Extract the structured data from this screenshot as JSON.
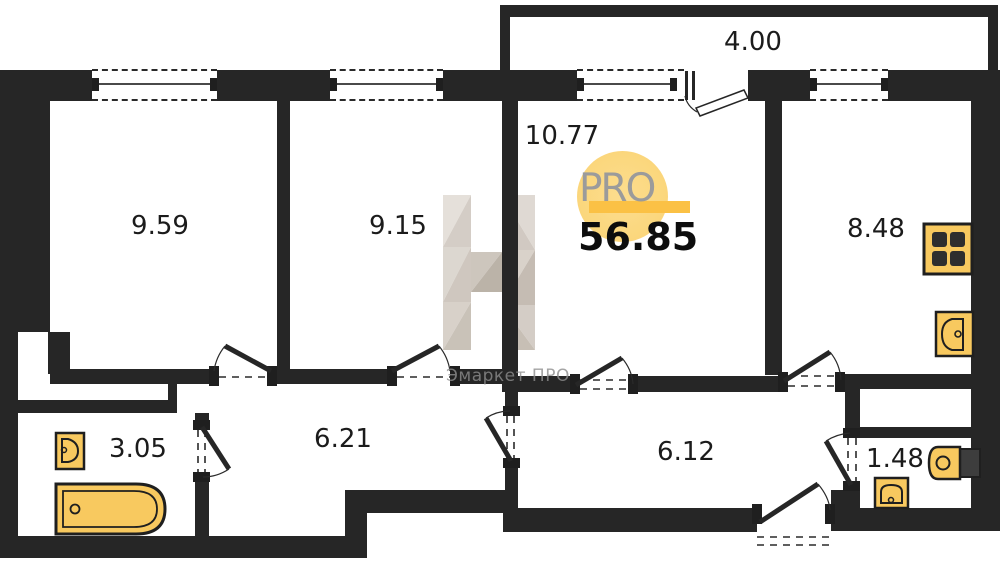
{
  "plan": {
    "total_area": "56.85",
    "rooms": {
      "bedroom1": {
        "label": "9.59"
      },
      "bedroom2": {
        "label": "9.15"
      },
      "hall": {
        "label": "10.77"
      },
      "balcony": {
        "label": "4.00"
      },
      "kitchen": {
        "label": "8.48"
      },
      "bathroom": {
        "label": "3.05"
      },
      "corridor1": {
        "label": "6.21"
      },
      "corridor2": {
        "label": "6.12"
      },
      "wc": {
        "label": "1.48"
      }
    },
    "brand": {
      "logo_text": "PRO",
      "watermark_text": "Эмаркет ПРО",
      "watermark_letter": "Н"
    },
    "icons": [
      "stove-icon",
      "kitchen-sink-icon",
      "bathroom-sink-icon",
      "bathtub-icon",
      "toilet-icon",
      "wc-sink-icon",
      "door-swing-icon",
      "window-icon"
    ],
    "colors": {
      "wall": "#262626",
      "fixture_fill": "#F8C95F",
      "logo_circle": "#FBD77D",
      "logo_bar": "#FBC145",
      "logo_text": "#9B9B9B",
      "watermark": "#8D8D8D"
    }
  }
}
